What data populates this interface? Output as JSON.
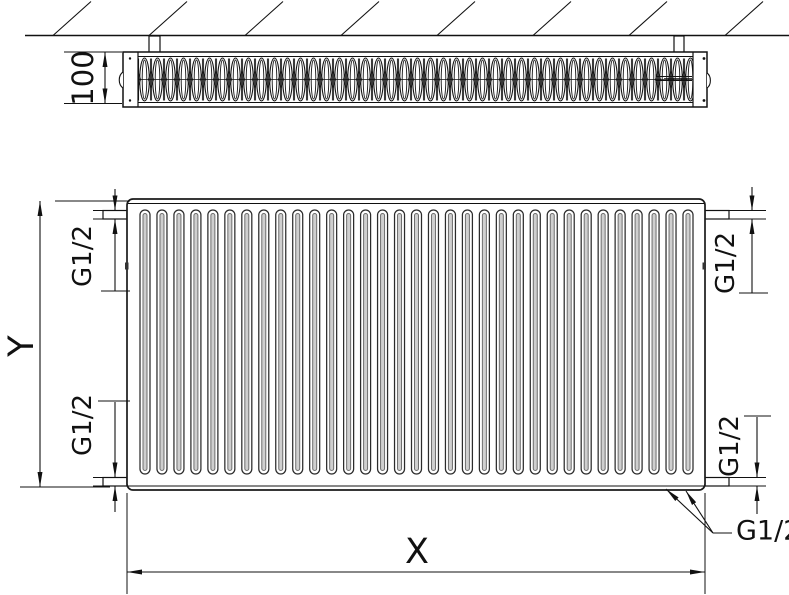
{
  "diagram": {
    "depth_dimension_label": "100",
    "height_dimension_label": "Y",
    "width_dimension_label": "X",
    "thread_label": "G1/2"
  }
}
